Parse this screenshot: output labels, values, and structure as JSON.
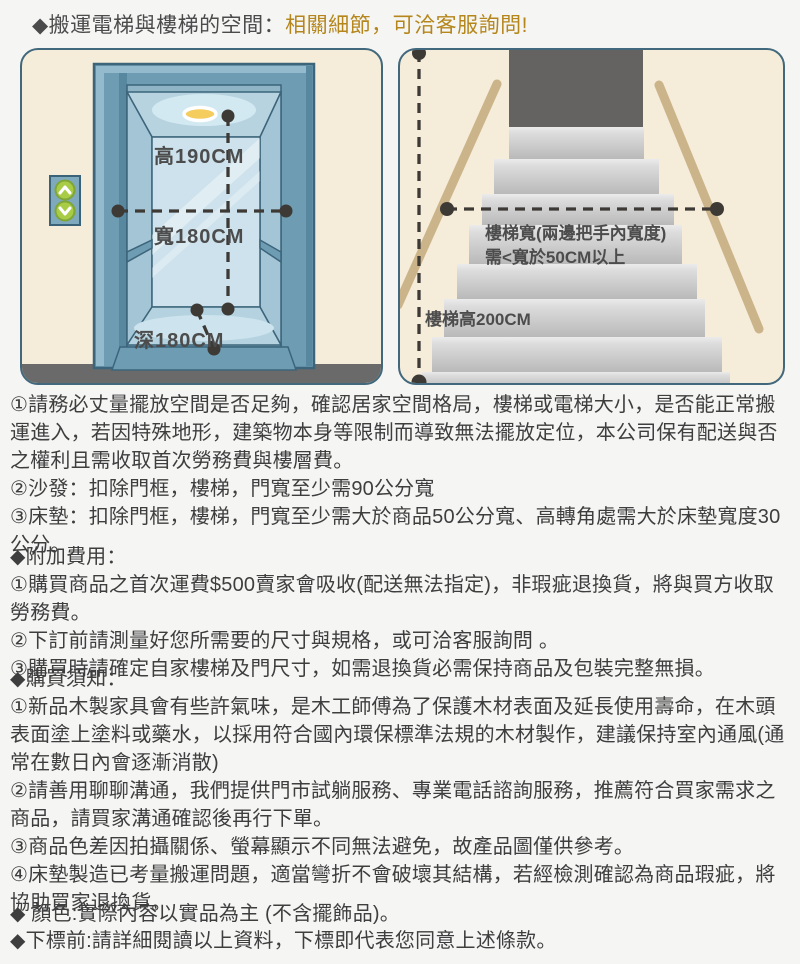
{
  "title": {
    "prefix": "◆搬運電梯與樓梯的空間：",
    "highlight": "相關細節，可洽客服詢問!"
  },
  "colors": {
    "accent": "#b5861b",
    "panel_bg": "#f5ecd9",
    "panel_border": "#41687c",
    "elevator_blue": "#6e9cb3",
    "dash": "#3d3a36",
    "landing_gray": "#656361",
    "handrail_tan": "#cbb48a"
  },
  "elevator_panel": {
    "labels": {
      "height": "高190CM",
      "width": "寬180CM",
      "depth": "深180CM"
    }
  },
  "stairs_panel": {
    "labels": {
      "stair_width_line1": "樓梯寬(兩邊把手內寬度)",
      "stair_width_line2": "需<寬於50CM以上",
      "stair_height": "樓梯高200CM"
    }
  },
  "moving_notes": {
    "items": [
      "①請務必丈量擺放空間是否足夠，確認居家空間格局，樓梯或電梯大小，是否能正常搬運進入，若因特殊地形，建築物本身等限制而導致無法擺放定位，本公司保有配送與否之權利且需收取首次勞務費與樓層費。",
      "②沙發：扣除門框，樓梯，門寬至少需90公分寬",
      "③床墊：扣除門框，樓梯，門寬至少需大於商品50公分寬、高轉角處需大於床墊寬度30公分。"
    ]
  },
  "additional_fees": {
    "heading": "◆附加費用：",
    "items": [
      "①購買商品之首次運費$500賣家會吸收(配送無法指定)，非瑕疵退換貨，將與買方收取勞務費。",
      "②下訂前請測量好您所需要的尺寸與規格，或可洽客服詢問 。",
      "③購買時請確定自家樓梯及門尺寸，如需退換貨必需保持商品及包裝完整無損。"
    ]
  },
  "purchase_notes": {
    "heading": "◆購買須知：",
    "items": [
      "①新品木製家具會有些許氣味，是木工師傅為了保護木材表面及延長使用壽命，在木頭表面塗上塗料或藥水，以採用符合國內環保標準法規的木材製作，建議保持室內通風(通常在數日內會逐漸消散)",
      "②請善用聊聊溝通，我們提供門市試躺服務、專業電話諮詢服務，推薦符合買家需求之商品，請買家溝通確認後再行下單。",
      "③商品色差因拍攝關係、螢幕顯示不同無法避免，故產品圖僅供參考。",
      "④床墊製造已考量搬運問題，適當彎折不會破壞其結構，若經檢測確認為商品瑕疵，將協助買家退換貨。"
    ]
  },
  "footer_notes": {
    "color_line": "◆ 顏色:實際內容以實品為主 (不含擺飾品)。",
    "order_line": "◆下標前:請詳細閱讀以上資料，下標即代表您同意上述條款。"
  }
}
